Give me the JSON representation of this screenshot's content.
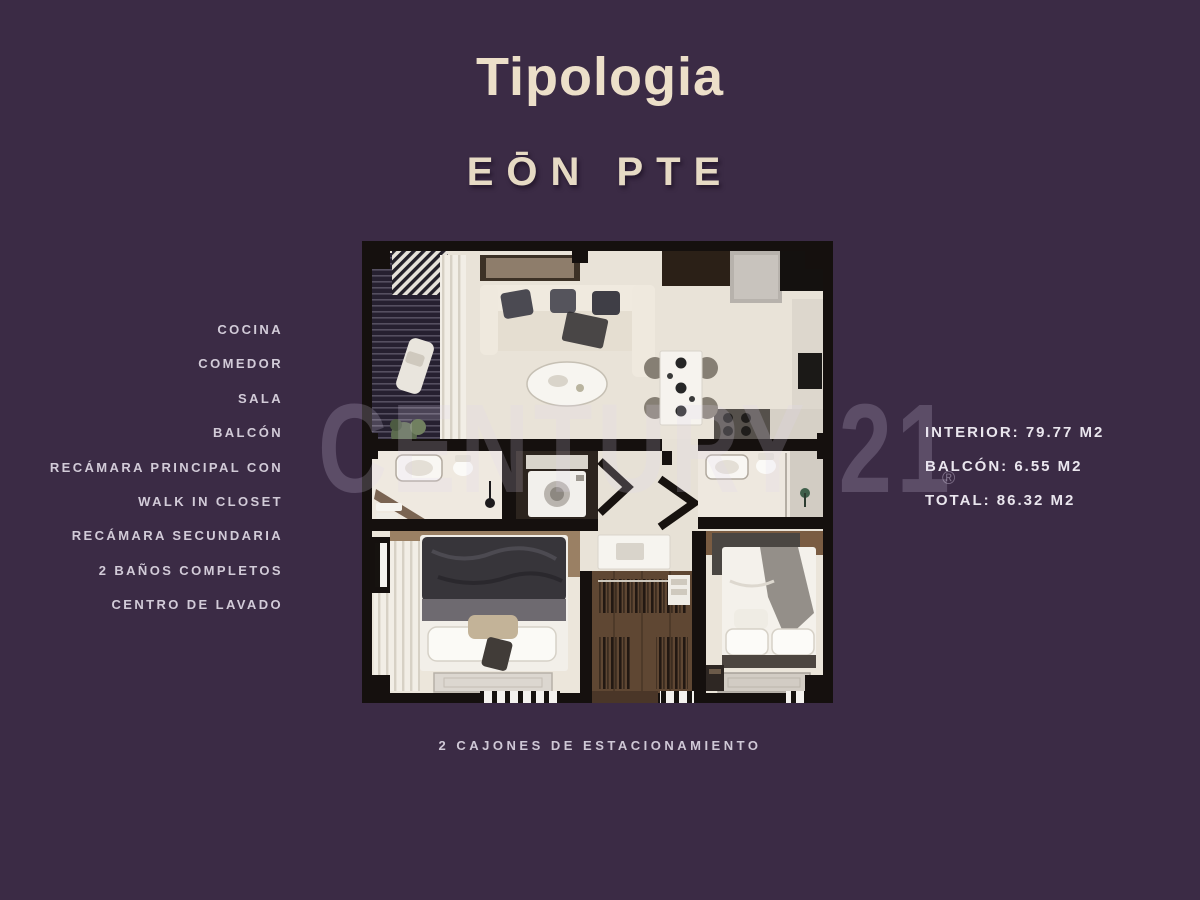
{
  "page": {
    "title": "Tipologia",
    "subtitle": "EŌN PTE"
  },
  "features": {
    "items": [
      "COCINA",
      "COMEDOR",
      "SALA",
      "BALCÓN",
      "RECÁMARA PRINCIPAL CON",
      "WALK IN CLOSET",
      "RECÁMARA SECUNDARIA",
      "2 BAÑOS COMPLETOS",
      "CENTRO DE LAVADO"
    ]
  },
  "areas": {
    "interior": "INTERIOR: 79.77 M2",
    "balcon": "BALCÓN: 6.55 M2",
    "total": "TOTAL: 86.32 M2"
  },
  "footer": {
    "parking": "2 CAJONES DE ESTACIONAMIENTO"
  },
  "watermark": {
    "text": "CENTURY 21",
    "registered": "®"
  },
  "colors": {
    "background": "#3b2b45",
    "heading": "#ecdfc9",
    "subtitle": "#e6dac4",
    "feature_text": "#d2cbd8",
    "stats_text": "#eae6ee",
    "watermark": "#e2d8ee"
  }
}
